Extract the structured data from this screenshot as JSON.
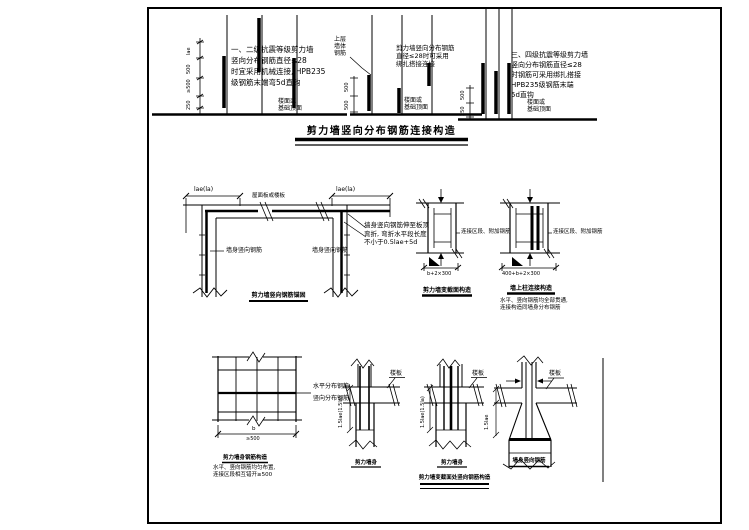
{
  "colors": {
    "ink": "#000000",
    "paper": "#ffffff"
  },
  "top_row": {
    "panel1": {
      "note_lines": [
        "一、二级抗震等级剪力墙",
        "竖向分布钢筋直径≤28",
        "时宜采用机械连接, HPB235",
        "级钢筋末端弯5d直钩"
      ],
      "ground_label_lines": [
        "楼面或",
        "基础顶面"
      ],
      "dim_labels": [
        "lae",
        "500",
        "≥500",
        "250"
      ]
    },
    "panel2": {
      "corner_label_lines": [
        "上层",
        "墙体",
        "钢筋"
      ],
      "note_lines": [
        "剪力墙竖向分布钢筋",
        "直径≤28时可采用",
        "绑扎搭接连接"
      ],
      "ground_label_lines": [
        "楼面或",
        "基础顶面"
      ],
      "dim_labels": [
        "500",
        "500"
      ]
    },
    "panel3": {
      "note_lines": [
        "三、四级抗震等级剪力墙",
        "竖向分布钢筋直径≤28",
        "时钢筋可采用绑扎搭接",
        "HPB235级钢筋末端",
        "5d直钩"
      ],
      "ground_label_lines": [
        "楼面或",
        "基础顶面"
      ],
      "dim_labels": [
        "500",
        "250"
      ]
    },
    "title": "剪力墙竖向分布钢筋连接构造"
  },
  "row2": {
    "corner_detail": {
      "dim_left": "lae(la)",
      "dim_right": "lae(la)",
      "slab_label": "屋面板或楼板",
      "left_bar_label": "墙身竖向钢筋",
      "right_bar_label": "墙身竖向钢筋",
      "side_note_lines": [
        "墙身竖向钢筋伸至板顶",
        "弯折, 弯折水平段长度",
        "不小于0.5lae+5d"
      ],
      "caption": "剪力墙竖向钢筋锚固"
    },
    "detailA": {
      "side_label": "连接区段、附加钢筋",
      "dim_label": "b+2×300",
      "caption": "剪力墙变截面构造"
    },
    "detailB": {
      "side_label": "连接区段、附加钢筋",
      "dim_label": "400+b+2×300",
      "caption": "墙上柱连接构造",
      "note_lines": [
        "水平、竖向钢筋均全部贯通,",
        "连接构造同墙身分布钢筋"
      ]
    }
  },
  "row3": {
    "detail1": {
      "label_top": "水平分布钢筋",
      "label_bottom": "竖向分布钢筋",
      "dim_top": "b",
      "dim_bottom": "≥500",
      "caption": "剪力墙身钢筋构造",
      "note_lines": [
        "水平、竖向钢筋均匀布置,",
        "连接区段相互错开≥500"
      ]
    },
    "detail2": {
      "slab_label": "楼板",
      "dim_label": "1.5lae(1.5la)",
      "caption": "剪力墙身"
    },
    "detail3": {
      "slab_label": "楼板",
      "dim_label": "1.5lae(1.5la)",
      "caption": "剪力墙身"
    },
    "detail4": {
      "slab_label": "楼板",
      "dim_label": "1.5lae",
      "caption": "墙身竖向钢筋"
    },
    "title": "剪力墙变截面处竖向钢筋构造"
  }
}
